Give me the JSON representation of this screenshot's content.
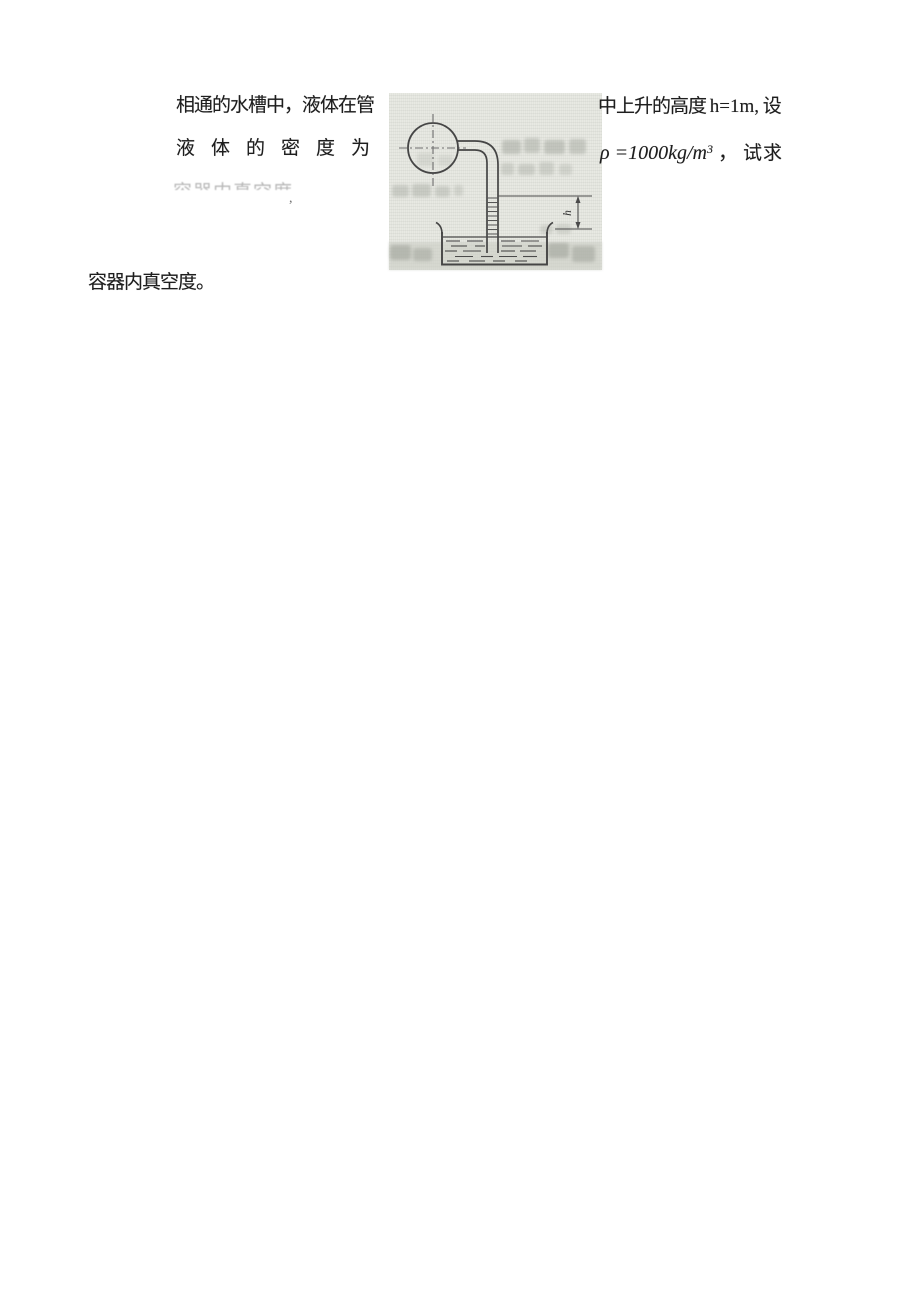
{
  "document": {
    "left_column": {
      "line1": "相通的水槽中，液体在管",
      "line2": "液体的密度为",
      "line3_partially_hidden": "容器内真空度",
      "stray_mark": ","
    },
    "right_column": {
      "line1_prefix": "中上升的高度",
      "line1_math": "h=1m,",
      "line1_suffix": "设",
      "formula_rho": "ρ",
      "formula_body": "=1000kg/m",
      "formula_sup": "3",
      "formula_comma": "，",
      "formula_suffix": "试求"
    },
    "bottom_line": "容器内真空度。"
  },
  "figure": {
    "h_label": "h",
    "background_color": "#e8e9e3",
    "shadow_band_color": "#cdcfc7",
    "ink_color": "#454545",
    "text_color": "#1c1c1c",
    "page_color": "#ffffff"
  }
}
